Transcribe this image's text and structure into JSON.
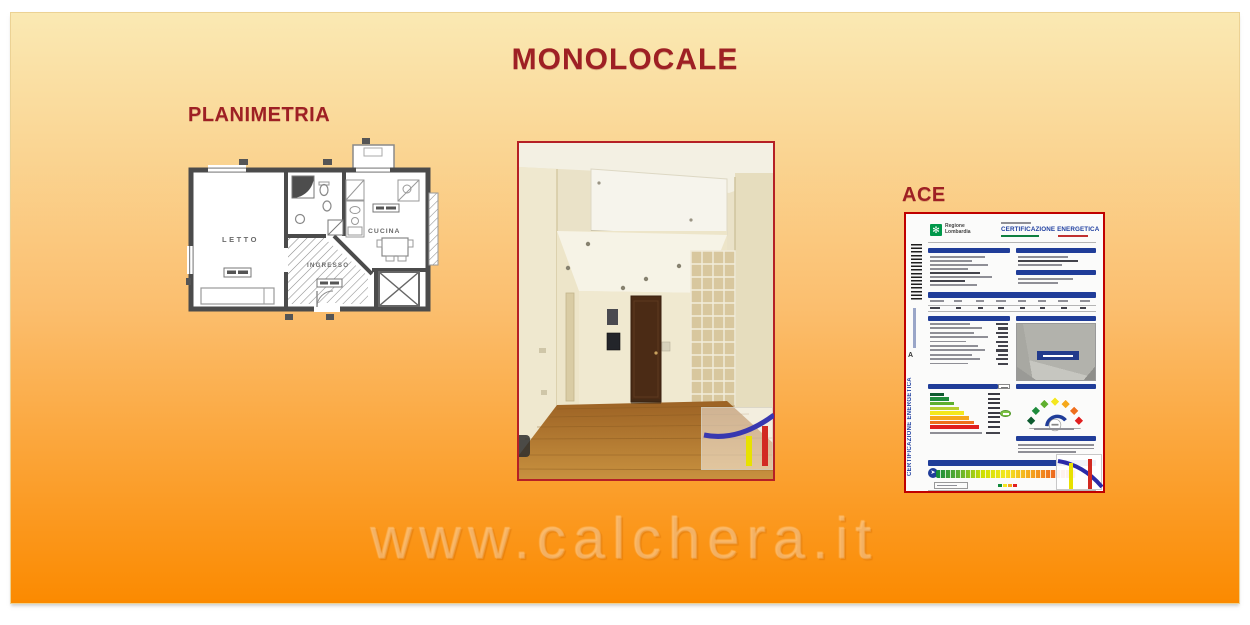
{
  "slide": {
    "title": "MONOLOCALE",
    "watermark": "www.calchera.it"
  },
  "colors": {
    "title-red": "#9E2024",
    "bg-top": "#FAE9B3",
    "bg-mid": "#FBBE6E",
    "bg-bottom": "#FB8A00",
    "photo-border": "#B52025",
    "cert-border": "#C00000",
    "blue-bar": "#203D99",
    "cert-title-blue": "#1F3FA0",
    "logo-green": "#00984A"
  },
  "floorplan": {
    "label": "PLANIMETRIA",
    "rooms": {
      "bedroom": "LETTO",
      "kitchen": "CUCINA",
      "entrance": "INGRESSO"
    }
  },
  "ace": {
    "label": "ACE",
    "region_line1": "Regione",
    "region_line2": "Lombardia",
    "doc_title": "CERTIFICAZIONE ENERGETICA",
    "side_mark": "A",
    "side_text": "CERTIFICAZIONE ENERGETICA",
    "energy_classes": [
      {
        "color": "#0E5B2F",
        "width": 14
      },
      {
        "color": "#1F8C3C",
        "width": 19
      },
      {
        "color": "#5FAF2E",
        "width": 24
      },
      {
        "color": "#B8CE2E",
        "width": 29
      },
      {
        "color": "#F4E71F",
        "width": 34
      },
      {
        "color": "#F5A81C",
        "width": 39
      },
      {
        "color": "#EE6F1E",
        "width": 44
      },
      {
        "color": "#E01F1F",
        "width": 49
      }
    ],
    "gauge_colors": [
      "#0E5B2F",
      "#1F8C3C",
      "#5FAF2E",
      "#F4E71F",
      "#F5A81C",
      "#EE6F1E",
      "#E01F1F"
    ]
  }
}
